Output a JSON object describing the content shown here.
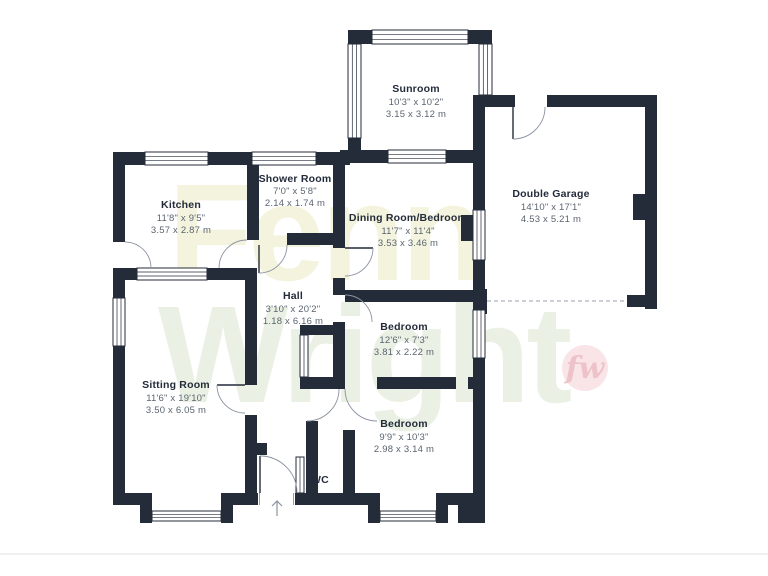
{
  "watermark": {
    "line1": "Fenn",
    "line2": "Wright",
    "color1": "#f4f4de",
    "color2": "#eaf1e4",
    "logo_text": "fw",
    "logo_bg": "#f9e5e7",
    "logo_color": "#eec2c9"
  },
  "plan": {
    "colors": {
      "wall": "#242c3a",
      "room_name": "#232b3a",
      "dims": "#5b6470",
      "background": "#ffffff"
    },
    "rooms": [
      {
        "id": "sunroom",
        "name": "Sunroom",
        "imperial": "10'3\" x 10'2\"",
        "metric": "3.15 x 3.12 m"
      },
      {
        "id": "double-garage",
        "name": "Double Garage",
        "imperial": "14'10\" x 17'1\"",
        "metric": "4.53 x 5.21 m"
      },
      {
        "id": "kitchen",
        "name": "Kitchen",
        "imperial": "11'8\" x 9'5\"",
        "metric": "3.57 x 2.87 m"
      },
      {
        "id": "shower-room",
        "name": "Shower Room",
        "imperial": "7'0\" x 5'8\"",
        "metric": "2.14 x 1.74 m"
      },
      {
        "id": "dining-room-bedroom",
        "name": "Dining Room/Bedroom",
        "imperial": "11'7\" x 11'4\"",
        "metric": "3.53 x 3.46 m"
      },
      {
        "id": "hall",
        "name": "Hall",
        "imperial": "3'10\" x 20'2\"",
        "metric": "1.18 x 6.16 m"
      },
      {
        "id": "bedroom-middle",
        "name": "Bedroom",
        "imperial": "12'6\" x 7'3\"",
        "metric": "3.81 x 2.22 m"
      },
      {
        "id": "sitting-room",
        "name": "Sitting Room",
        "imperial": "11'6\" x 19'10\"",
        "metric": "3.50 x 6.05 m"
      },
      {
        "id": "bedroom-bottom",
        "name": "Bedroom",
        "imperial": "9'9\" x 10'3\"",
        "metric": "2.98 x 3.14 m"
      },
      {
        "id": "wc",
        "name": "WC"
      }
    ]
  }
}
